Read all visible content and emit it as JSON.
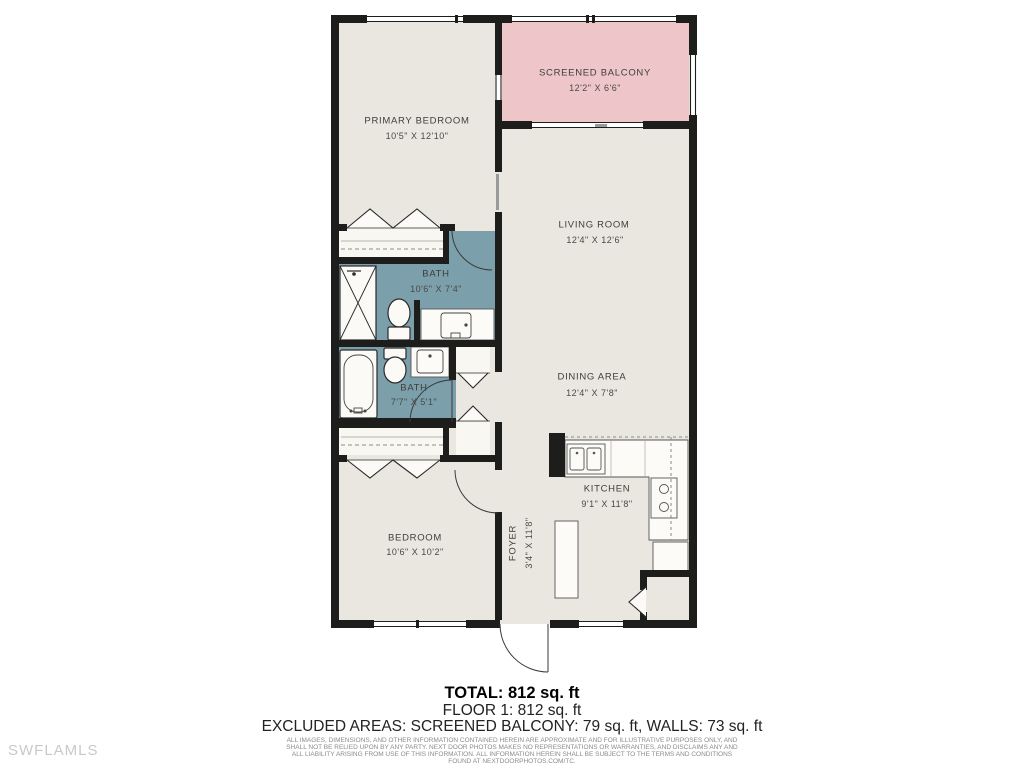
{
  "watermark": "SWFLAMLS",
  "colors": {
    "floor": "#e9e7e0",
    "balcony": "#eec6ca",
    "bath": "#7b9fab",
    "wall": "#1d1d1b",
    "fixture": "#fbfaf7"
  },
  "rooms": {
    "primary_bedroom": {
      "name": "PRIMARY BEDROOM",
      "dims": "10'5\" X 12'10\""
    },
    "screened_balcony": {
      "name": "SCREENED BALCONY",
      "dims": "12'2\" X 6'6\""
    },
    "living_room": {
      "name": "LIVING ROOM",
      "dims": "12'4\" X 12'6\""
    },
    "bath1": {
      "name": "BATH",
      "dims": "10'6\" X 7'4\""
    },
    "bath2": {
      "name": "BATH",
      "dims": "7'7\" X 5'1\""
    },
    "dining_area": {
      "name": "DINING AREA",
      "dims": "12'4\" X 7'8\""
    },
    "kitchen": {
      "name": "KITCHEN",
      "dims": "9'1\" X 11'8\""
    },
    "bedroom": {
      "name": "BEDROOM",
      "dims": "10'6\" X 10'2\""
    },
    "foyer": {
      "name": "FOYER",
      "dims": "3'4\" X 11'8\""
    }
  },
  "summary": {
    "total": "TOTAL: 812 sq. ft",
    "floor1": "FLOOR 1: 812 sq. ft",
    "excluded": "EXCLUDED AREAS: SCREENED BALCONY: 79 sq. ft, WALLS: 73 sq. ft"
  },
  "disclaimer": "ALL IMAGES, DIMENSIONS, AND OTHER INFORMATION CONTAINED HEREIN ARE APPROXIMATE AND FOR ILLUSTRATIVE PURPOSES ONLY, AND SHALL NOT BE RELIED UPON BY ANY PARTY. NEXT DOOR PHOTOS MAKES NO REPRESENTATIONS OR WARRANTIES, AND DISCLAIMS ANY AND ALL LIABILITY ARISING FROM USE OF THIS INFORMATION. ALL INFORMATION HEREIN SHALL BE SUBJECT TO THE TERMS AND CONDITIONS FOUND AT NEXTDOORPHOTOS.COM/TC."
}
